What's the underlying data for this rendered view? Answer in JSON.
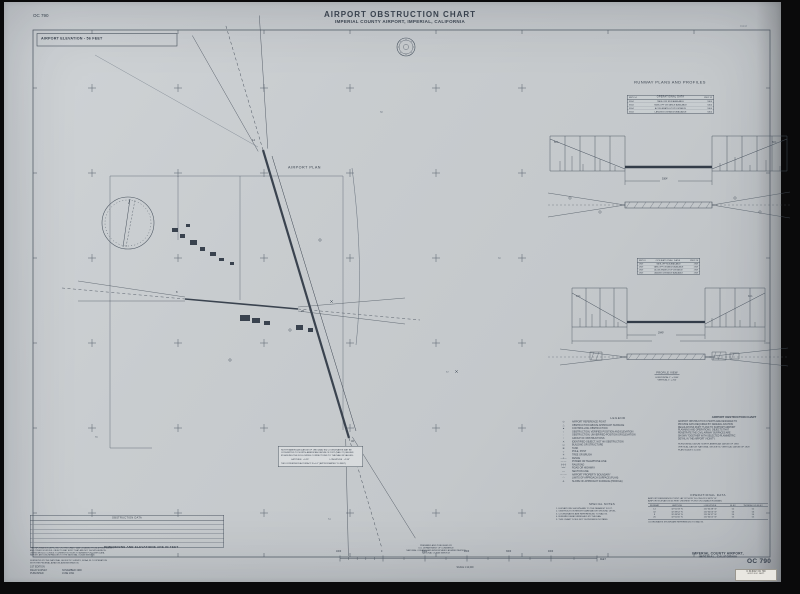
{
  "frame": {
    "chart_id_top": "OC 790",
    "title": "AIRPORT  OBSTRUCTION  CHART",
    "subtitle": "IMPERIAL COUNTY AIRPORT, IMPERIAL, CALIFORNIA",
    "top_right_note": "91243",
    "elevation_box": "AIRPORT ELEVATION - 56 FEET",
    "plan_label": "AIRPORT PLAN",
    "dimensions_note": "DIMENSIONS AND ELEVATIONS ARE IN FEET",
    "spots": [
      "58",
      "60",
      "55",
      "57",
      "54"
    ],
    "plan_runways": {
      "r14": "14",
      "r32": "32",
      "r8": "8",
      "r26": "26"
    }
  },
  "runway_panel": {
    "title": "RUNWAY PLANS AND PROFILES",
    "profiles": [
      {
        "table_title": "OPERATIONAL DATA",
        "col_left": "RWY 14",
        "col_right": "RWY 32",
        "rows": [
          {
            "label": "TAKE-OFF RUN AVAILABLE",
            "left": "5304",
            "right": "5304"
          },
          {
            "label": "TAKE-OFF DISTANCE AVAILABLE",
            "left": "5304",
            "right": "5304"
          },
          {
            "label": "ACCELERATE-STOP DISTANCE",
            "left": "5304",
            "right": "5304"
          },
          {
            "label": "LANDING DISTANCE AVAILABLE",
            "left": "5304",
            "right": "5304"
          }
        ],
        "slope_left": "50:1",
        "slope_right": "50:1",
        "length_label": "5304'",
        "rwy_left": "14",
        "rwy_right": "32"
      },
      {
        "table_title": "OPERATIONAL DATA",
        "col_left": "RWY 8",
        "col_right": "RWY 26",
        "rows": [
          {
            "label": "TAKE-OFF RUN AVAILABLE",
            "left": "2949",
            "right": "2949"
          },
          {
            "label": "TAKE-OFF DISTANCE AVAILABLE",
            "left": "2949",
            "right": "2949"
          },
          {
            "label": "ACCELERATE-STOP DISTANCE",
            "left": "2949",
            "right": "2949"
          },
          {
            "label": "LANDING DISTANCE AVAILABLE",
            "left": "2949",
            "right": "2949"
          }
        ],
        "slope_left": "34:1",
        "slope_right": "34:1",
        "length_label": "2949'",
        "rwy_left": "8",
        "rwy_right": "26"
      }
    ],
    "profile_caption": {
      "title": "PROFILE VIEW",
      "h": "HORIZONTAL  1\" = 2000'",
      "v": "VERTICAL  1\" = 200'"
    }
  },
  "legend": {
    "title": "LEGEND",
    "items": [
      {
        "sym": "⊙",
        "label": "AIRPORT REFERENCE POINT"
      },
      {
        "sym": "△",
        "label": "OBSTRUCTION ABOVE APPROACH SURFACE"
      },
      {
        "sym": "▲",
        "label": "CONTROLLING OBSTRUCTION"
      },
      {
        "sym": "○",
        "label": "OBSTRUCTION, VERIFIED POSITION AND ELEVATION"
      },
      {
        "sym": "◌",
        "label": "OBSTRUCTION, UNVERIFIED POSITION OR ELEVATION"
      },
      {
        "sym": "⁞",
        "label": "GROUP OF OBSTRUCTIONS"
      },
      {
        "sym": "✕",
        "label": "IDENTIFIED OBJECT, NOT AN OBSTRUCTION"
      },
      {
        "sym": "▭",
        "label": "BUILDING OR STRUCTURE"
      },
      {
        "sym": "⊕",
        "label": "TANK"
      },
      {
        "sym": "┬",
        "label": "POLE, POST"
      },
      {
        "sym": "✳",
        "label": "TREE OR BRUSH"
      },
      {
        "sym": "—x—",
        "label": "FENCE"
      },
      {
        "sym": "—·—",
        "label": "POWER OR TELEPHONE LINE"
      },
      {
        "sym": "┼┼┼",
        "label": "RAILROAD"
      },
      {
        "sym": "══",
        "label": "ROAD OR HIGHWAY"
      },
      {
        "sym": "┄┄",
        "label": "SECTION LINE"
      },
      {
        "sym": "—··—",
        "label": "AIRPORT PROPERTY BOUNDARY"
      },
      {
        "sym": "◠",
        "label": "LIMITS OF APPROACH SURFACE (PLAN)"
      },
      {
        "sym": "∠",
        "label": "SLOPE OF APPROACH SURFACE (PROFILE)"
      }
    ]
  },
  "aoc_info": {
    "title": "AIRPORT OBSTRUCTION CHART",
    "lines": [
      "AIRPORT OBSTRUCTION CHARTS ARE DESIGNED TO",
      "PROVIDE DATA REQUIRED BY FEDERAL AVIATION",
      "REGULATIONS PART 77 AND TO SUPPORT AIRPORT",
      "PLANNING AND OPERATIONS. OBJECTS THAT",
      "PENETRATE THE CIVIL AIRWAY SURFACES ARE",
      "SHOWN TOGETHER WITH SELECTED PLANIMETRIC",
      "DETAIL IN THE AIRPORT VICINITY."
    ],
    "specs": [
      "HORIZONTAL DATUM:  NORTH AMERICAN DATUM OF 1983",
      "VERTICAL DATUM:  NATIONAL GEODETIC VERTICAL DATUM OF 1929",
      "PLAN SCALE  1:12,000"
    ]
  },
  "special_notes": {
    "title": "SPECIAL NOTES",
    "lines": [
      "1. ELEVATIONS SHOWN ARE TO THE NEAREST FOOT.",
      "2. OBSTRUCTION HEIGHTS ARE ABOVE GROUND LEVEL.",
      "3. COORDINATES ARE REFERENCED TO NAD 83.",
      "4. RUNWAY DATA FURNISHED BY THE FAA.",
      "5. THIS CHART DOES NOT SUPERSEDE NOTAMS."
    ]
  },
  "operational_data": {
    "title": "OPERATIONAL DATA",
    "header_lines": [
      "AIRPORT REFERENCE POINT    LAT 32°50'05\" N    LONG 115°34'25\" W",
      "AIRPORT ELEVATION 56 FEET  (HIGHEST POINT ON USABLE RUNWAY)"
    ],
    "columns": [
      "RUNWAY",
      "LATITUDE",
      "LONGITUDE",
      "ELEV",
      "THRESHOLD ELEV"
    ],
    "rows": [
      {
        "rwy": "14",
        "lat": "32°50'33\" N",
        "lon": "115°34'48\" W",
        "elev": "52",
        "thr": "52"
      },
      {
        "rwy": "32",
        "lat": "32°49'52\" N",
        "lon": "115°34'06\" W",
        "elev": "56",
        "thr": "56"
      },
      {
        "rwy": "8",
        "lat": "32°49'58\" N",
        "lon": "115°34'37\" W",
        "elev": "54",
        "thr": "54"
      },
      {
        "rwy": "26",
        "lat": "32°50'00\" N",
        "lon": "115°34'05\" W",
        "elev": "55",
        "thr": "55"
      }
    ],
    "footnote": "COORDINATES SHOWN ARE REFERENCED TO NAD 83."
  },
  "nad_note": {
    "lines": [
      "NORTH AMERICAN DATUM OF 1983 (NAD 83) COORDINATES MAY BE",
      "CONVERTED TO NORTH AMERICAN DATUM OF 1927 (NAD 27) VALUES",
      "BY ADDING THE FOLLOWING CORRECTIONS TO THE NAD 83 VALUES:"
    ],
    "lat_label": "LATITUDE",
    "lat_value": "+0.25\"",
    "lon_label": "LONGITUDE",
    "lon_value": "+2.95\"",
    "footer": "THIS CONVERSION ACCURACY IS ±0.1\" (APPROXIMATELY 10 FEET)."
  },
  "bottom_left": {
    "box_title": "OBSTRUCTION DATA",
    "fine_print": [
      "THE INFORMATION DEPICTED ON THIS CHART WAS OBTAINED FROM A FIELD SURVEY",
      "AND OTHER SOURCES. OBJECTS MAY EXIST THAT ARE NOT SHOWN HEREON.",
      "USERS SHOULD CONSULT CURRENT NOTICES TO AIRMEN FOR LATER DATA.",
      "REPORT ANY DISCREPANCIES TO THE NATIONAL OCEAN SERVICE."
    ],
    "credit_lines": [
      "SURVEYED BY THE NATIONAL GEODETIC SURVEY, NOAA, IN COOPERATION",
      "WITH THE FEDERAL AVIATION ADMINISTRATION."
    ],
    "edition_rows": [
      {
        "label": "1ST EDITION",
        "value": ""
      },
      {
        "label": "FIELD SURVEY",
        "value": "NOVEMBER 1990"
      },
      {
        "label": "PUBLISHED",
        "value": "JUNE 1991"
      }
    ]
  },
  "publisher": {
    "lines": [
      "PREPARED AND PUBLISHED BY",
      "U.S. DEPARTMENT OF COMMERCE",
      "NATIONAL OCEANIC AND ATMOSPHERIC ADMINISTRATION",
      "NATIONAL OCEAN SERVICE"
    ]
  },
  "scale_bar": {
    "labels": [
      "1000",
      "0",
      "1000",
      "2000",
      "3000",
      "4000"
    ],
    "unit": "FEET",
    "ratio": "SCALE 1:12,000"
  },
  "footer_right": {
    "line1": "IMPERIAL COUNTY AIRPORT,",
    "line2": "IMPERIAL, CALIFORNIA",
    "chart_id": "OC 790",
    "sticker_line1": "C 30.60/2: OC 790",
    "sticker_line2": "GOVT. DOC. DEPT."
  },
  "colors": {
    "ink": "#39424e",
    "paper": "#c7cbce",
    "background": "#0a0a0b"
  }
}
